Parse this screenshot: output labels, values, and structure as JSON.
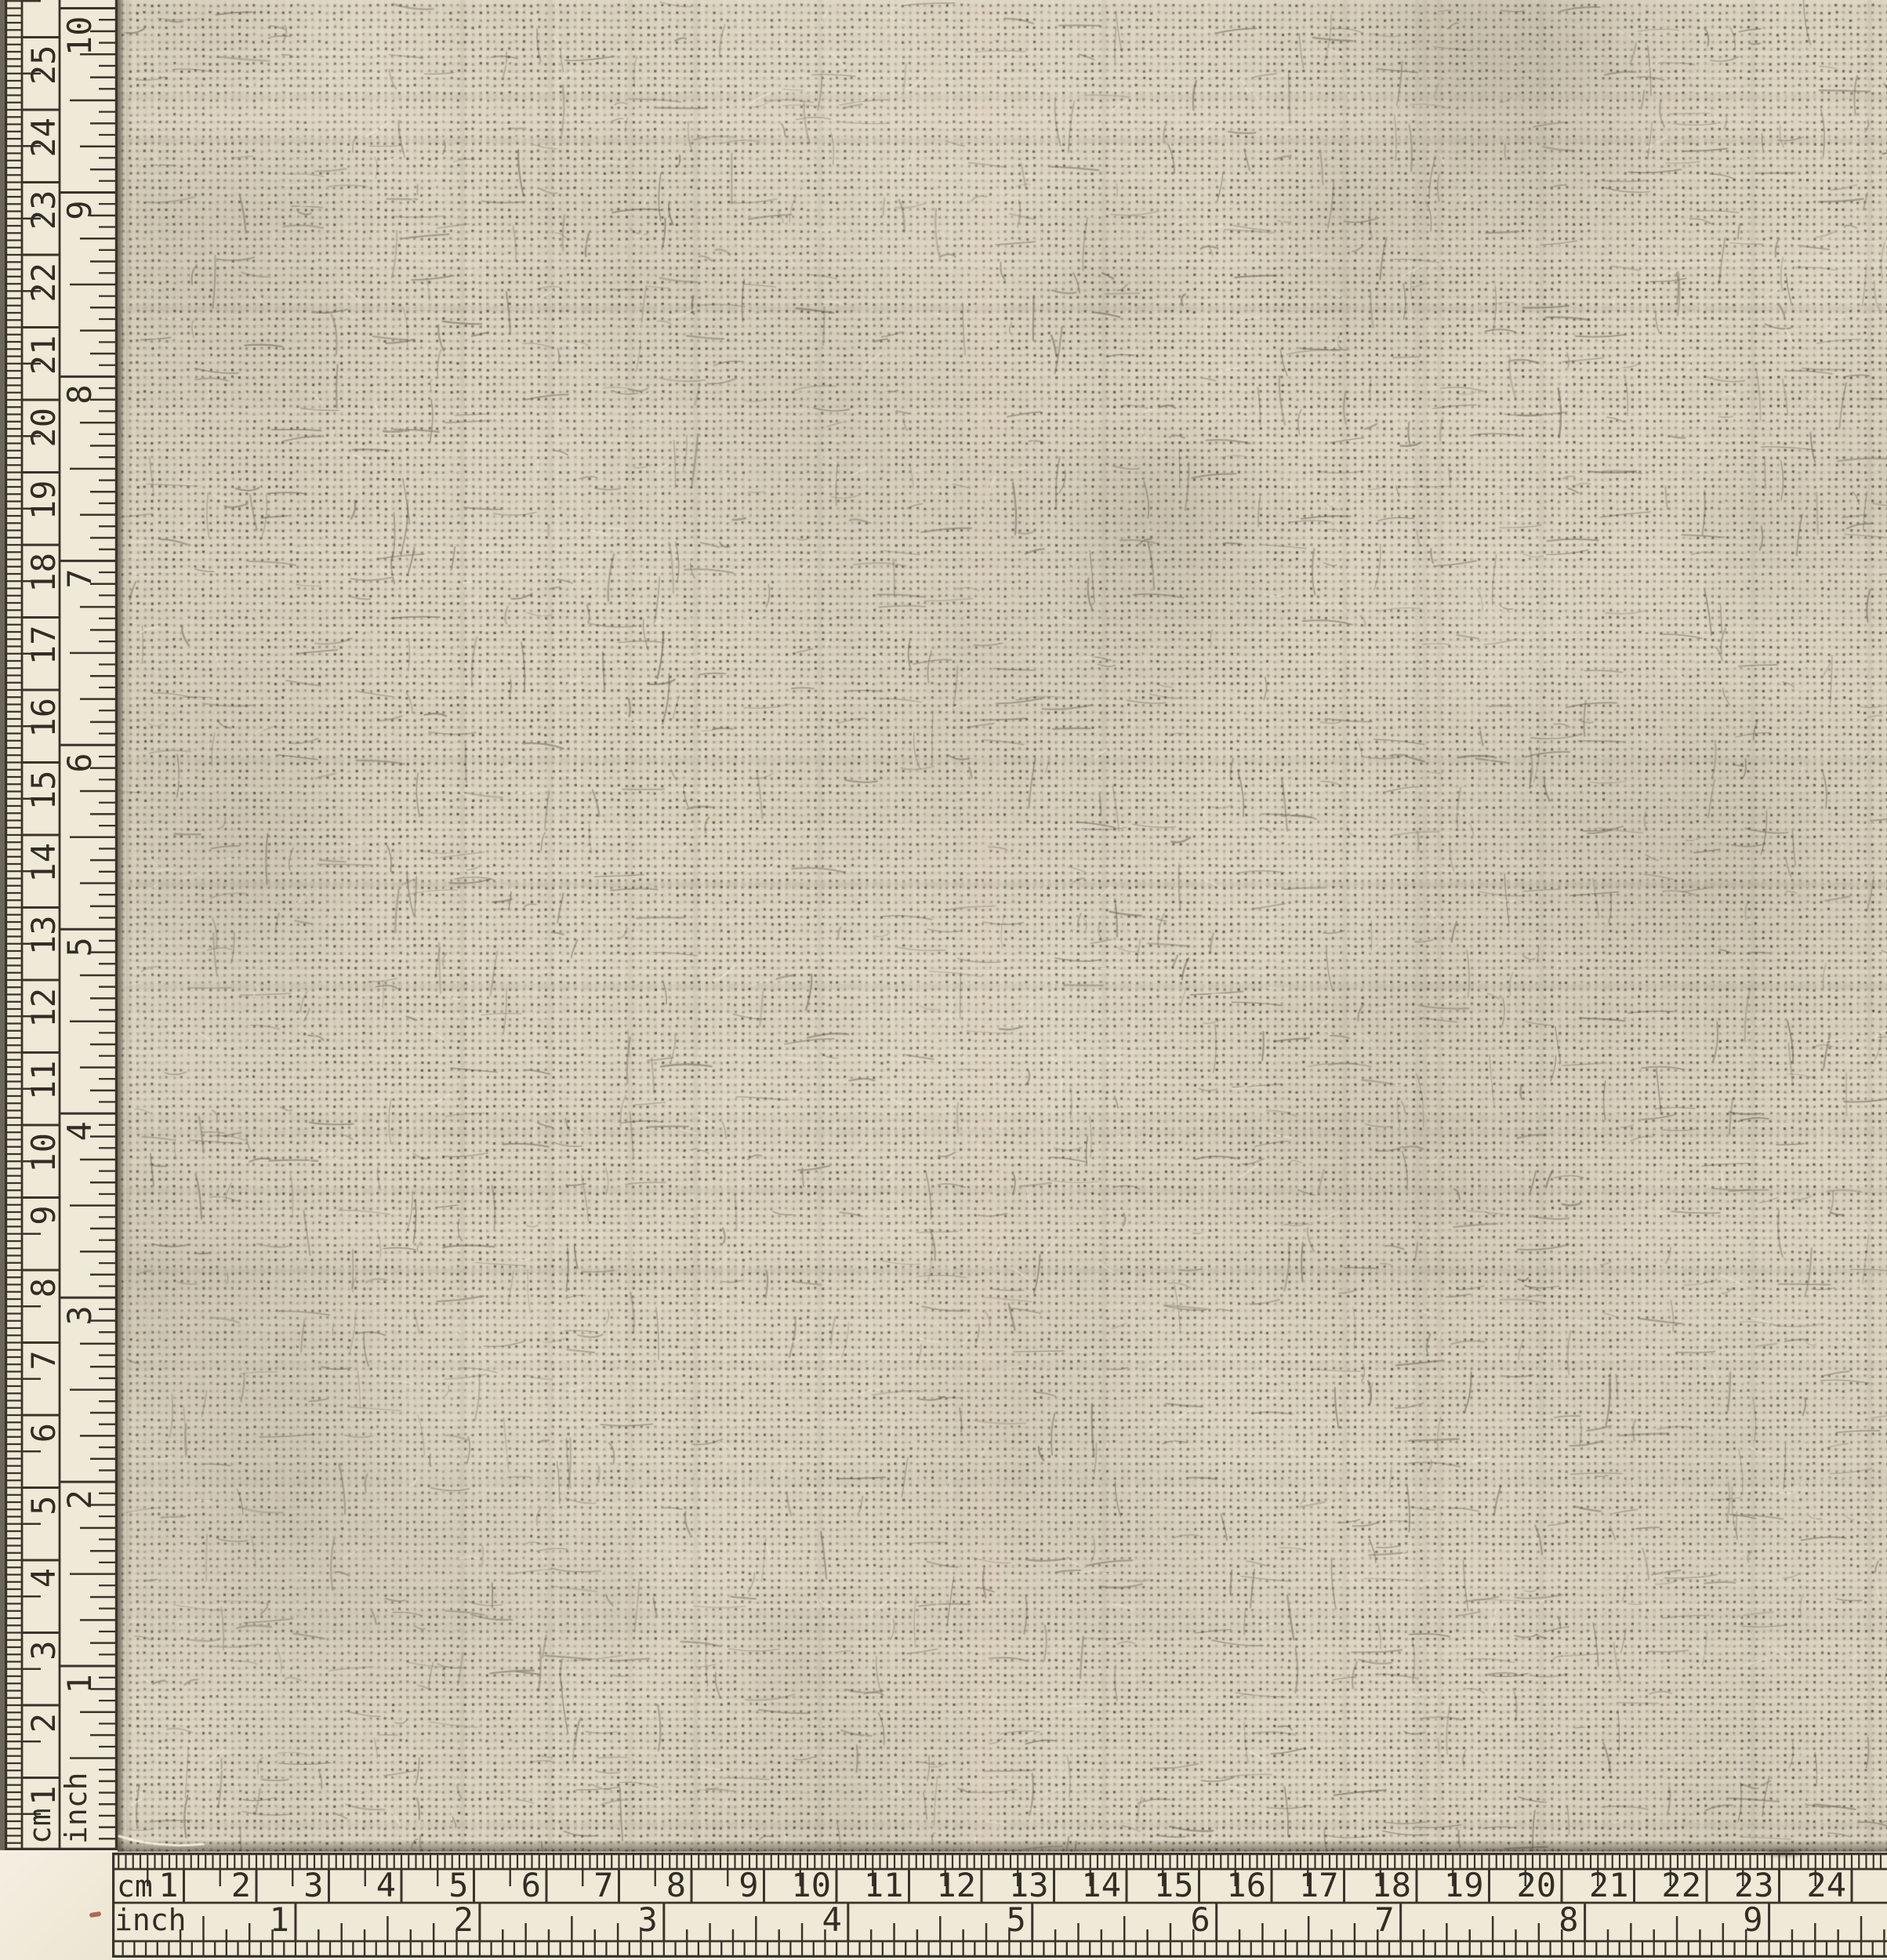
{
  "scene": {
    "subject": "linen-fabric-sample-with-photo-scales"
  },
  "left_ruler": {
    "cm_unit_label": "cm",
    "inch_unit_label": "inch",
    "cm_tick_labels": [
      "1",
      "2",
      "3",
      "4",
      "5",
      "6",
      "7",
      "8",
      "9",
      "10",
      "11",
      "12",
      "13",
      "14",
      "15",
      "16",
      "17",
      "18",
      "19",
      "20",
      "21",
      "22",
      "23",
      "24",
      "25"
    ],
    "inch_tick_labels": [
      "1",
      "2",
      "3",
      "4",
      "5",
      "6",
      "7",
      "8",
      "9",
      "10"
    ]
  },
  "bottom_ruler": {
    "cm_unit_label": "cm",
    "inch_unit_label": "inch",
    "cm_tick_labels": [
      "1",
      "2",
      "3",
      "4",
      "5",
      "6",
      "7",
      "8",
      "9",
      "10",
      "11",
      "12",
      "13",
      "14",
      "15",
      "16",
      "17",
      "18",
      "19",
      "20",
      "21",
      "22",
      "23",
      "24"
    ],
    "inch_tick_labels": [
      "1",
      "2",
      "3",
      "4",
      "5",
      "6",
      "7",
      "8",
      "9"
    ]
  },
  "colors": {
    "ruler_paper": "#efe9d7",
    "corner_paper": "#f3eee0",
    "ink": "#3a342b",
    "number_ink": "#322d24",
    "scan_edge": "#6b675b",
    "fabric_base": "#d0c8b3",
    "fabric_thread_light": "#e2dac6",
    "fabric_hole": "#4e4835",
    "fabric_slub": "#8d8676",
    "fabric_edge_shadow": "#574f3e",
    "red_mark": "#9c4a2f"
  }
}
